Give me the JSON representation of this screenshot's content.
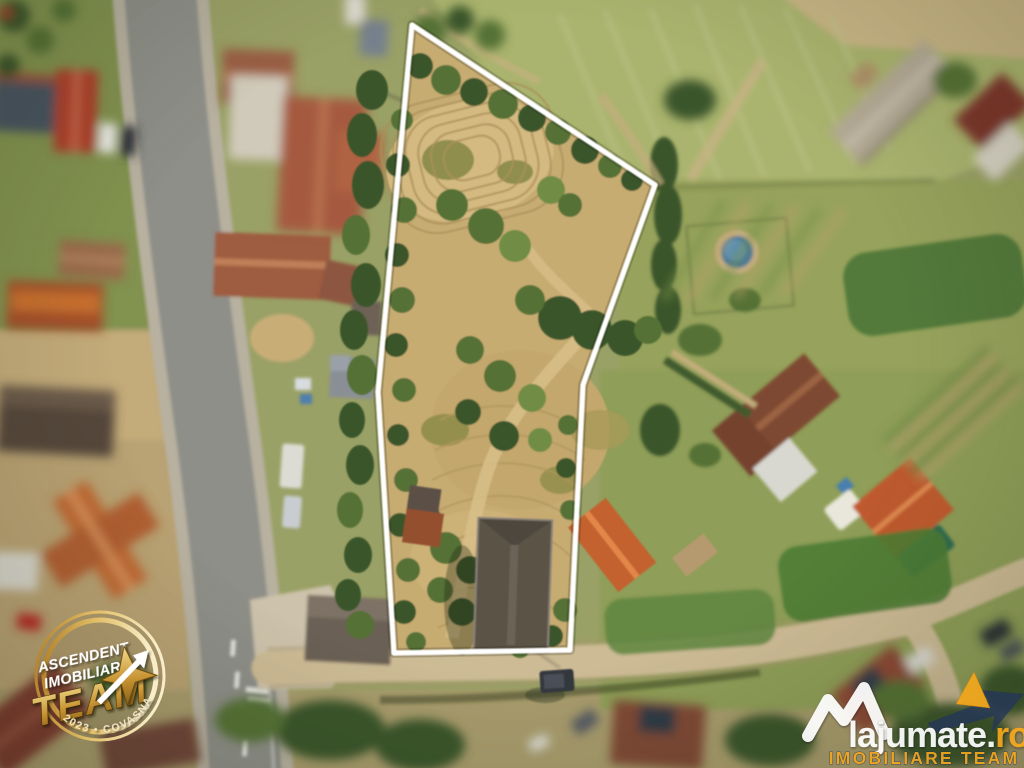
{
  "badge": {
    "line1": "ASCENDENT",
    "line2": "IMOBILIARE",
    "line3": "TEAM",
    "footer": "2023 • COVASNA"
  },
  "watermark": {
    "brand": "lajumate",
    "dot": ".",
    "tld": "ro",
    "tagline": "IMOBILIARE TEAM"
  },
  "colors": {
    "plot_outline": "#ffffff",
    "badge_gold": "#d9ad4e",
    "watermark_yellow": "#f2a71d",
    "watermark_navy": "#23355c"
  }
}
